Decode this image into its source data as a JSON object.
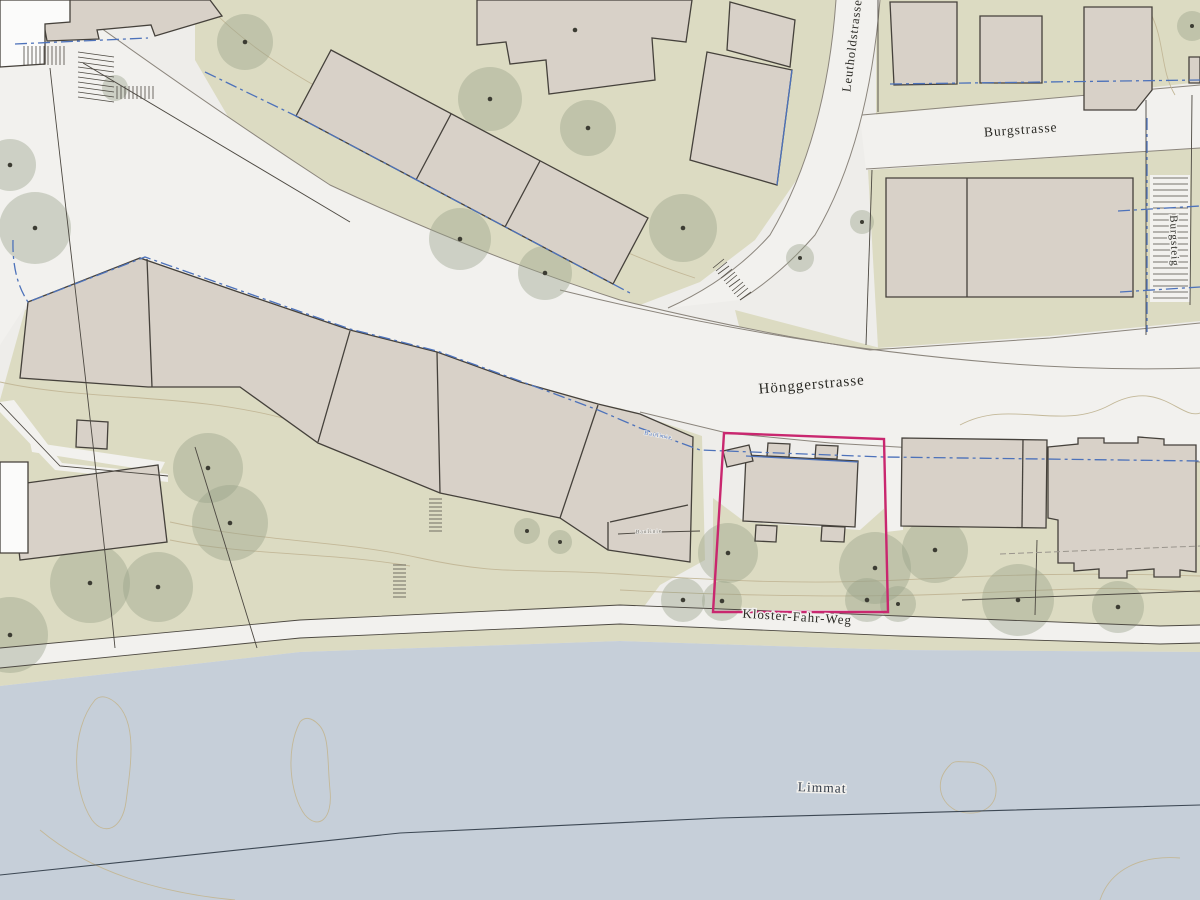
{
  "map": {
    "kind": "cadastral-site-plan",
    "labels": {
      "hoenggerstrasse": "Hönggerstrasse",
      "burgstrasse": "Burgstrasse",
      "leutholdstrasse": "Leutholdstrasse",
      "burgsteig": "Burgsteig",
      "kloster_fahr_weg": "Kloster-Fahr-Weg",
      "limmat": "Limmat",
      "baulinie": "Baulinie",
      "small_parcel_label": "Baulinie"
    },
    "colors": {
      "background": "#eeedea",
      "street_fill": "#f2f1ee",
      "street_edge": "#8b857c",
      "green": "#dcdbc2",
      "building": "#d8d1c8",
      "building_outline": "#45413b",
      "white_building": "#fbfbfa",
      "tree": "#97a086",
      "tree_dot": "#3c3c33",
      "river": "#c6cfd9",
      "river_line": "#3d4854",
      "contour": "#c3b898",
      "baulinie_blue": "#4d72ba",
      "site_boundary": "#c9276f",
      "path_edge": "#4c4841",
      "dashed_gray": "#9a958d",
      "label_dark": "#2b2a25",
      "water_label": "#333c49",
      "small_label_gray": "#6b675f"
    }
  }
}
